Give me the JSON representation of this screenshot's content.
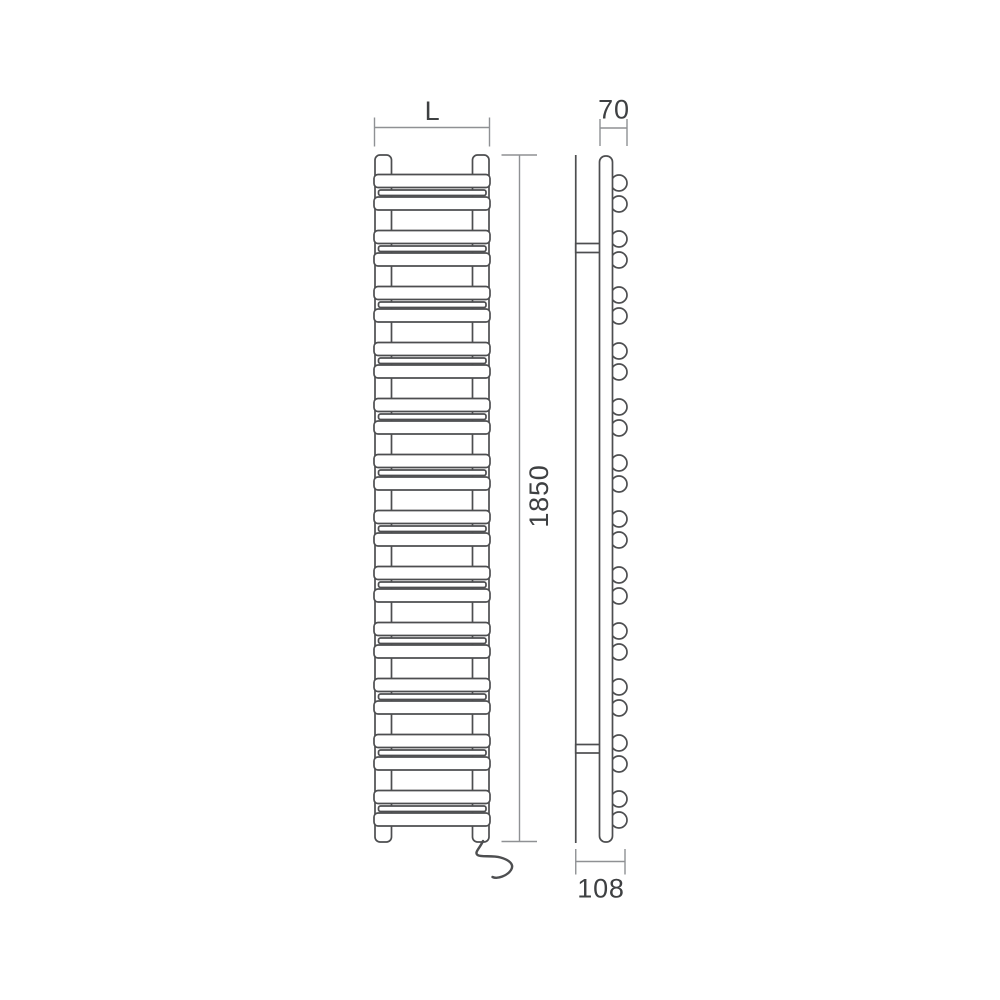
{
  "drawing": {
    "kind": "heated-towel-rail-technical-drawing",
    "views": {
      "front": {
        "width_label": "L",
        "height_label": "1850"
      },
      "side": {
        "depth_label": "70",
        "wall_depth_label": "108"
      }
    },
    "structure": {
      "tube_groups": 12,
      "tubes_per_group": 2,
      "wall_brackets": 2,
      "has_power_cable": true
    },
    "colors": {
      "background": "#ffffff",
      "body_line": "#4d4e50",
      "dimension_line": "#8f9194",
      "label_text": "#3e4042"
    }
  }
}
